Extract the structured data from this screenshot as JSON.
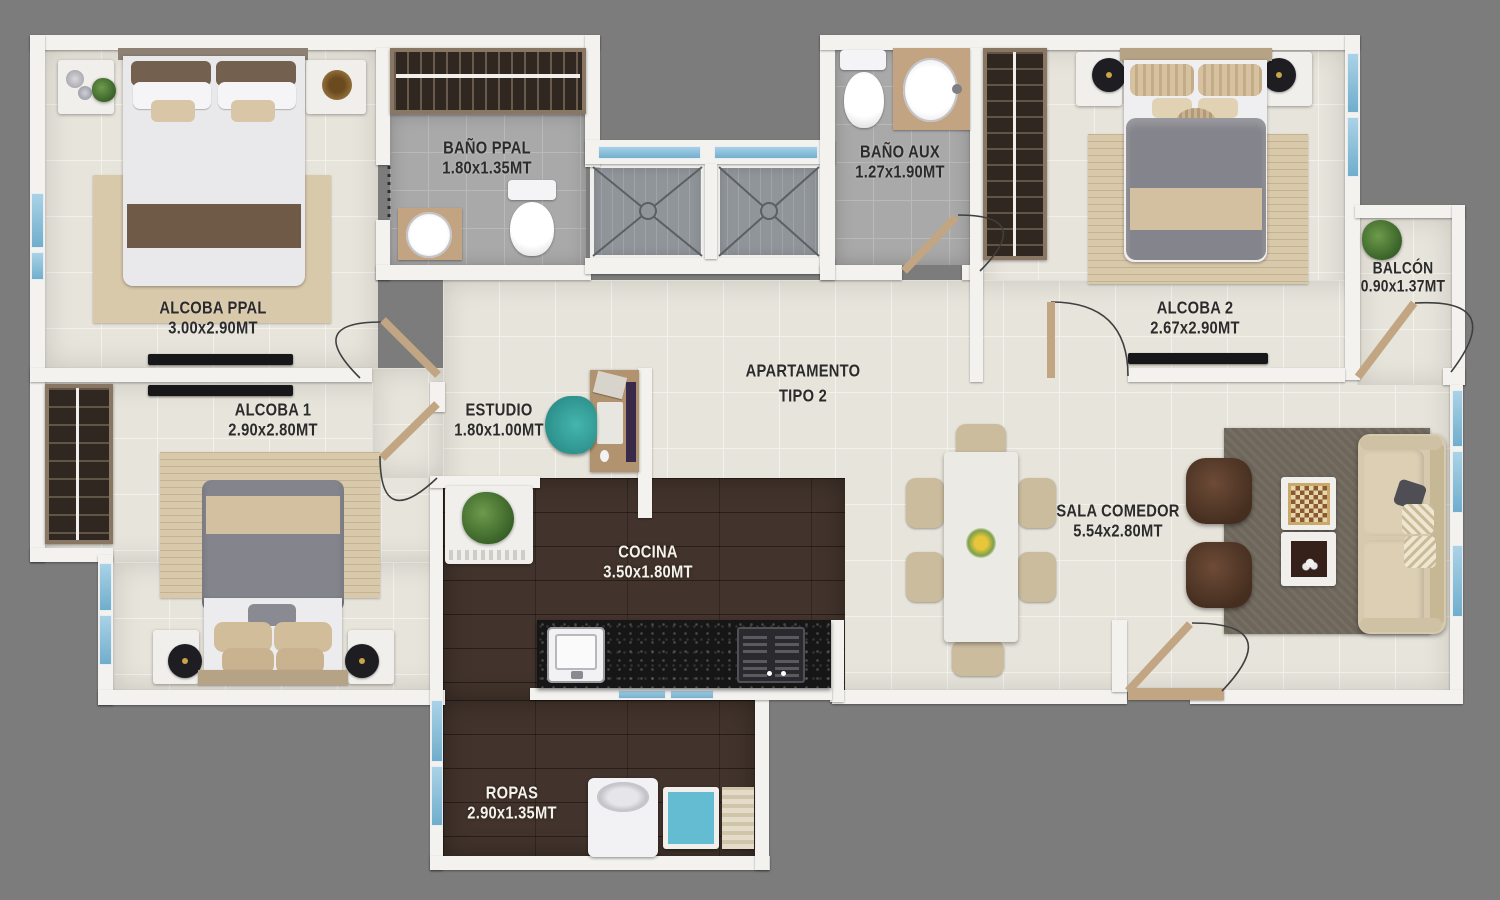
{
  "plan": {
    "title_line1": "APARTAMENTO",
    "title_line2": "TIPO 2",
    "rooms": {
      "alcoba_ppal": {
        "name": "ALCOBA PPAL",
        "dims": "3.00x2.90MT"
      },
      "bano_ppal": {
        "name": "BAÑO PPAL",
        "dims": "1.80x1.35MT"
      },
      "bano_aux": {
        "name": "BAÑO AUX",
        "dims": "1.27x1.90MT"
      },
      "alcoba_2": {
        "name": "ALCOBA 2",
        "dims": "2.67x2.90MT"
      },
      "balcon": {
        "name": "BALCÓN",
        "dims": "0.90x1.37MT"
      },
      "alcoba_1": {
        "name": "ALCOBA 1",
        "dims": "2.90x2.80MT"
      },
      "estudio": {
        "name": "ESTUDIO",
        "dims": "1.80x1.00MT"
      },
      "cocina": {
        "name": "COCINA",
        "dims": "3.50x1.80MT"
      },
      "sala_comedor": {
        "name": "SALA COMEDOR",
        "dims": "5.54x2.80MT"
      },
      "ropas": {
        "name": "ROPAS",
        "dims": "2.90x1.35MT"
      }
    },
    "colors": {
      "background": "#7c7c7c",
      "wall": "#f3f2ef",
      "floor_tile": "#e7e4db",
      "floor_bath": "#a9a9a9",
      "floor_wood": "#42342c",
      "counter_granite": "#161616",
      "window_glass": "#8ec4de",
      "door_wood": "#c2a582",
      "label_dark": "#2b2b2b",
      "label_light": "#f4f2ea"
    }
  }
}
